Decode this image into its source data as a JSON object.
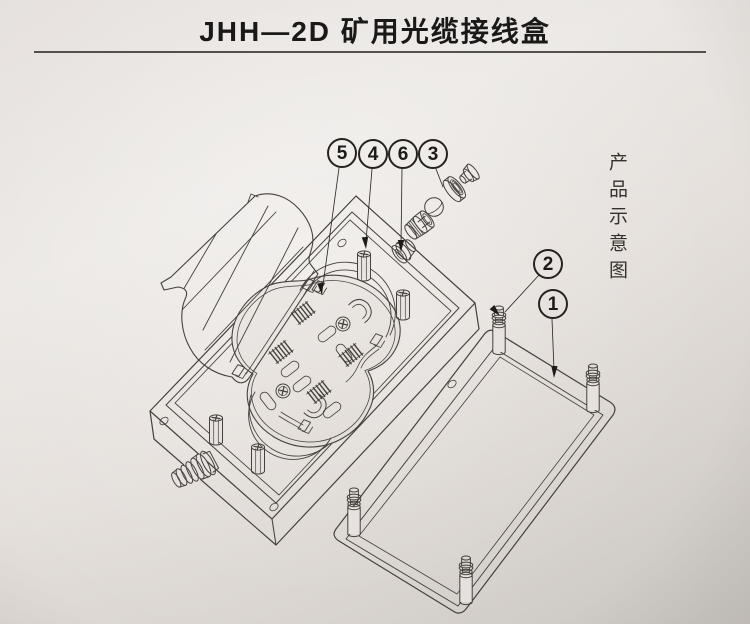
{
  "header": {
    "title": "JHH—2D 矿用光缆接线盒"
  },
  "side_caption": {
    "text": "产品示意图"
  },
  "callouts": [
    {
      "label": "5"
    },
    {
      "label": "4"
    },
    {
      "label": "6"
    },
    {
      "label": "3"
    },
    {
      "label": "2"
    },
    {
      "label": "1"
    }
  ],
  "colors": {
    "paper_highlight": "#f0edea",
    "paper_mid": "#e7e2de",
    "paper_shadow": "#d0ccc7",
    "line_ink": "#45413c",
    "text_ink": "#1b1918"
  }
}
